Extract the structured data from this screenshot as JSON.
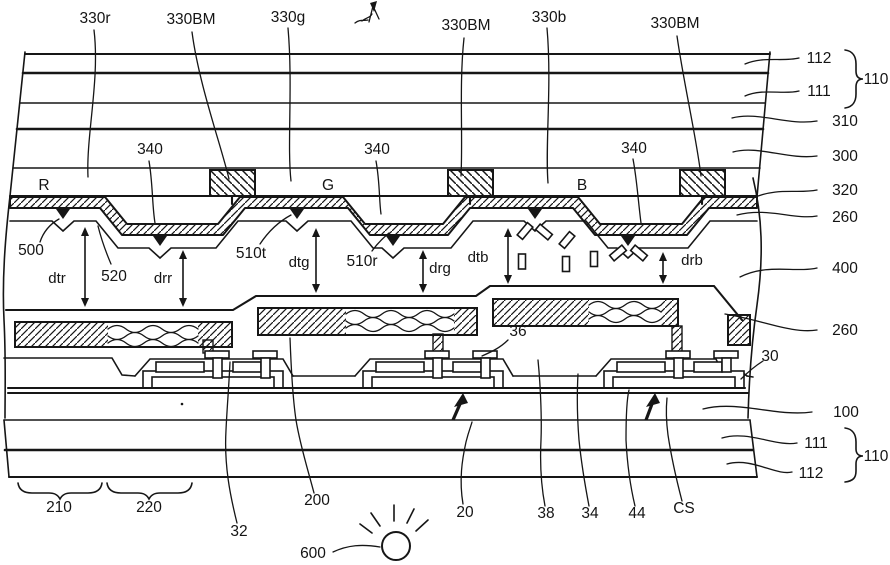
{
  "fig": {
    "top": {
      "r": "330r",
      "bm1": "330BM",
      "g": "330g",
      "bm2": "330BM",
      "b": "330b",
      "bm3": "330BM",
      "ovc1": "340",
      "ovc2": "340",
      "ovc3": "340"
    },
    "cf": {
      "r": "R",
      "g": "G",
      "b": "B"
    },
    "mid": {
      "p500": "500",
      "p520": "520",
      "p510t": "510t",
      "p510r": "510r",
      "dtr": "dtr",
      "drr": "drr",
      "dtg": "dtg",
      "drg": "drg",
      "dtb": "dtb",
      "drb": "drb",
      "n36": "36",
      "n30": "30"
    },
    "right": {
      "t112": "112",
      "t111": "111",
      "t110": "110",
      "n310": "310",
      "n300": "300",
      "n320": "320",
      "n260a": "260",
      "n400": "400",
      "n260b": "260",
      "n100": "100",
      "b111": "111",
      "b112": "112",
      "b110": "110"
    },
    "bottom": {
      "n210": "210",
      "n220": "220",
      "n32": "32",
      "n200": "200",
      "n600": "600",
      "n20": "20",
      "n38": "38",
      "n34": "34",
      "n44": "44",
      "cs": "CS"
    }
  }
}
